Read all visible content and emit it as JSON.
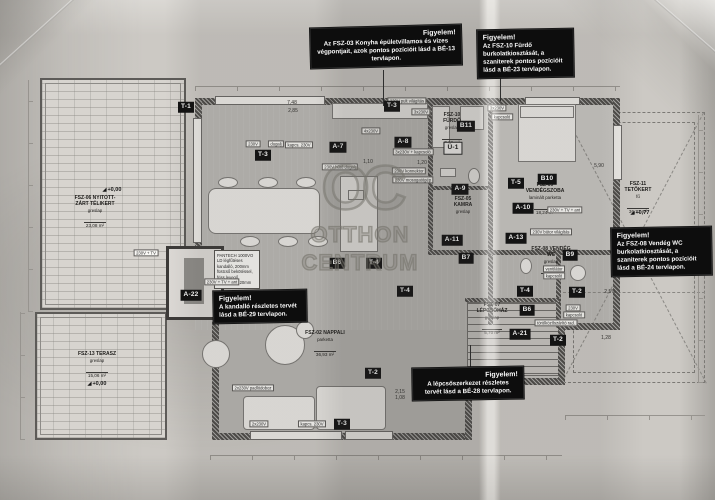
{
  "watermark": {
    "logo": "OC",
    "line1": "OTTHON",
    "line2": "CENTRUM"
  },
  "notes": [
    {
      "title": "Figyelem!",
      "body": "Az FSZ-03 Konyha épületvillamos és vizes végpontjait, azok pontos pozícióit lásd a BÉ-13 tervlapon."
    },
    {
      "title": "Figyelem!",
      "body": "Az FSZ-10 Fürdő burkolatkiosztását, a szaniterek pontos pozícióit lásd a BÉ-23 tervlapon."
    },
    {
      "title": "Figyelem!",
      "body": "Az FSZ-08 Vendég WC burkolatkiosztását, a szaniterek pontos pozícióit lásd a BÉ-24 tervlapon."
    },
    {
      "title": "Figyelem!",
      "body": "A kandalló részletes tervét lásd a BÉ-29 tervlapon."
    },
    {
      "title": "Figyelem!",
      "body": "A lépcsőszerkezet részletes tervét lásd a BÉ-28 tervlapon."
    }
  ],
  "rooms": [
    {
      "name": "FSZ-06 NYITOTT-ZÁRT TÉLIKERT",
      "finish": "greslap",
      "area": "23,08 m²"
    },
    {
      "name": "FSZ-13 TERASZ",
      "finish": "greslap",
      "area": "15,06 m²"
    },
    {
      "name": "FSZ-11 TETŐKERT",
      "finish": "fű",
      "area": "36,71 m²"
    },
    {
      "name": "FSZ-02 NAPPALI",
      "finish": "parketta",
      "area": "36,93 m²"
    },
    {
      "name": "FSZ-10 FÜRDŐ",
      "finish": "greslap",
      "area": "7,38 m²"
    },
    {
      "name": "FSZ-09 VENDÉGSZOBA",
      "finish": "laminált parketta",
      "area": "18,24 m²"
    },
    {
      "name": "FSZ-05 KAMRA",
      "finish": "greslap",
      "area": ""
    },
    {
      "name": "FSZ-08 VENDÉG WC",
      "finish": "greslap",
      "area": "2,20 m²"
    },
    {
      "name": "FSZ-07 LÉPCSŐHÁZ",
      "finish": "greslap",
      "area": "5,70 m²"
    }
  ],
  "tags": [
    "T-1",
    "T-3",
    "T-3",
    "T-3",
    "T-2",
    "T-2",
    "T-2",
    "T-4",
    "T-4",
    "T-5",
    "A-7",
    "A-8",
    "A-9",
    "A-10",
    "A-13",
    "A-11",
    "B7",
    "A-21",
    "A-22",
    "B6",
    "B6",
    "B9",
    "B10",
    "B11",
    "T-4",
    "Ü-1"
  ],
  "electric_labels": [
    "230V",
    "dugalj",
    "kapcs. 230V",
    "230V pult világítás",
    "3x230V",
    "4x230V",
    "3x230V + kapcsoló",
    "230V hűtő dugalj",
    "230V konnektor",
    "230V mosogatógép",
    "3x230V",
    "kapcsoló",
    "230V + TV + ant",
    "230V bútor világítás",
    "ventilátor",
    "kapcsoló",
    "230V",
    "kapcsoló",
    "törölközőszárító rad.",
    "2x230V padlódoboz",
    "2x230V",
    "kapcs. 230V",
    "230V + TV + ant",
    "230V + TV"
  ],
  "fireplace_note": "PANTECH 1000VO LD légfűtéses kandalló, 200mm füstcső bekötéssel, friss levegő bevezetés 120mm",
  "dimension_labels": [
    "7,48",
    "2,85",
    "1,10",
    "1,20",
    "5,90",
    "2,15",
    "1,08",
    "1,28",
    "2,5%"
  ],
  "elevation_markers": [
    "+0,00",
    "+0,00",
    "+0,77"
  ],
  "colors": {
    "note_bg": "#0d0d0d",
    "tag_bg": "#101010",
    "paper": "#ccc9c4",
    "wall": "#4e4c49",
    "watermark": "#76746d"
  }
}
